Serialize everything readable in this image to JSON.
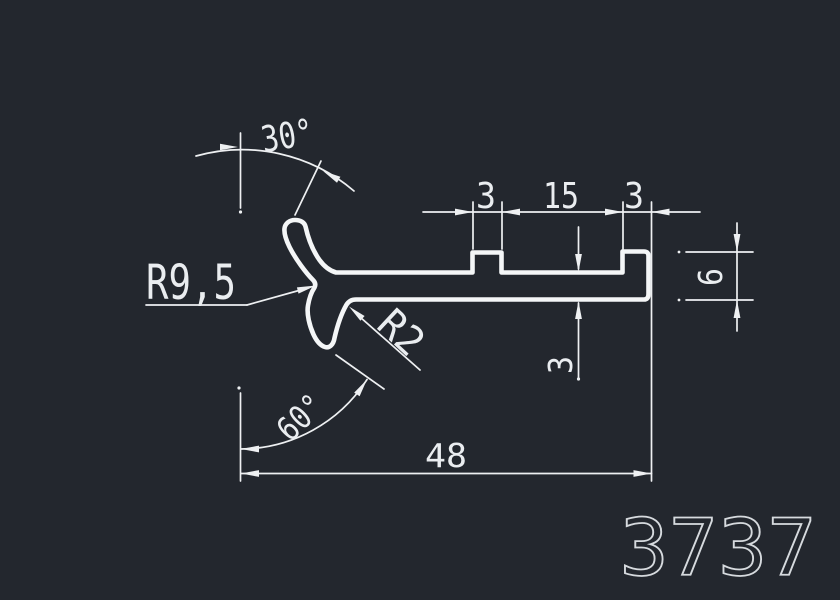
{
  "canvas": {
    "background_color": "#23272e",
    "line_color": "#eef0f2",
    "part_number_color": "#d6dade"
  },
  "labels": {
    "angle_upper": "30°",
    "radius_upper": "R9,5",
    "radius_fillet": "R2",
    "angle_lower": "60°",
    "tab_left_width": "3",
    "tab_gap": "15",
    "tab_right_width": "3",
    "wall_thickness": "3",
    "lip_height": "6",
    "overall_width": "48",
    "part_number": "3737"
  }
}
